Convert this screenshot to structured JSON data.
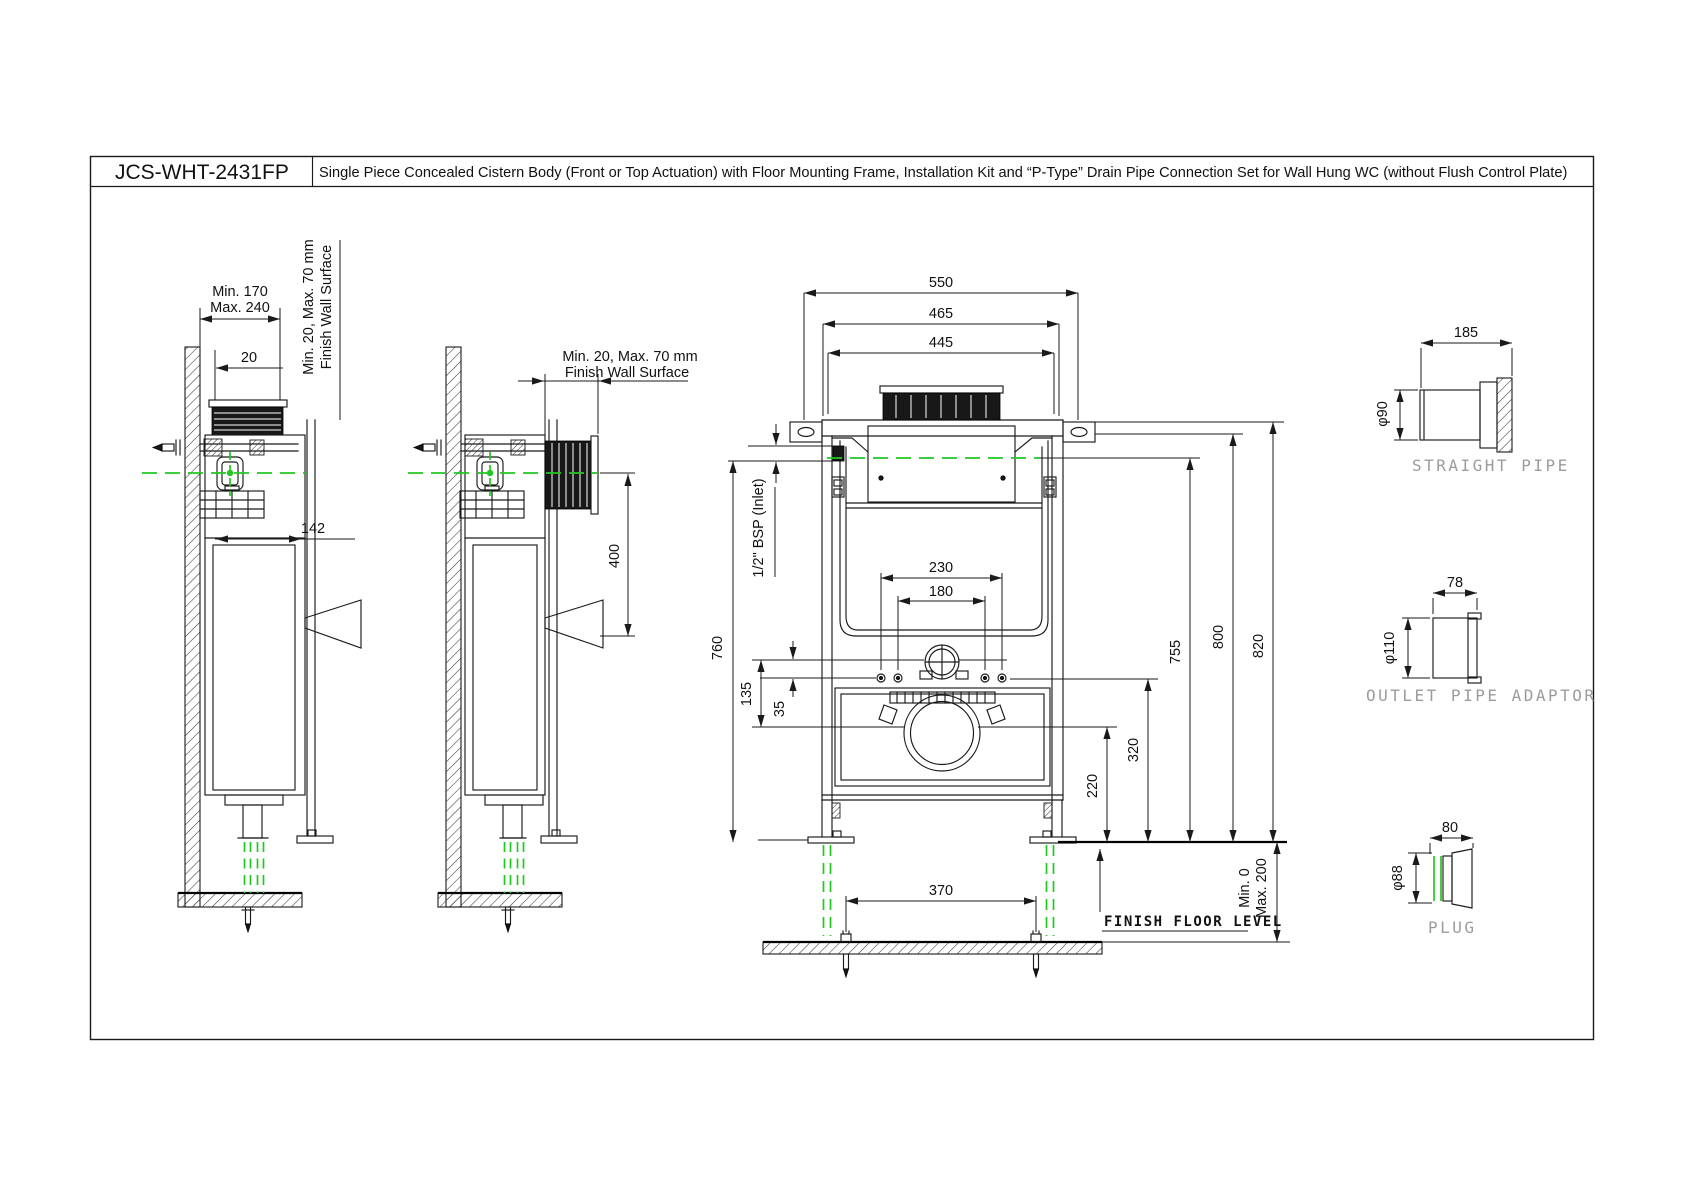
{
  "title": {
    "model": "JCS-WHT-2431FP",
    "description": "Single Piece Concealed Cistern Body (Front or Top Actuation) with Floor Mounting Frame, Installation Kit and “P-Type” Drain Pipe Connection Set for Wall Hung WC (without Flush Control Plate)"
  },
  "colors": {
    "line": "#1a1a1a",
    "centerline": "#22c822",
    "accessory_label": "#9c9c9c",
    "floor_label": "#111111",
    "background": "#ffffff"
  },
  "side_view_top_actuation": {
    "wall_offset_min": "Min. 170",
    "wall_offset_max": "Max. 240",
    "tube_gap": "20",
    "body_depth": "142",
    "finish_wall_line1": "Min. 20, Max. 70 mm",
    "finish_wall_line2": "Finish Wall Surface"
  },
  "side_view_front_actuation": {
    "finish_wall_line1": "Min. 20, Max. 70 mm",
    "finish_wall_line2": "Finish Wall Surface",
    "actuation_span": "400"
  },
  "front_view": {
    "overall_width": "550",
    "frame_width": "465",
    "inner_width": "445",
    "inlet_label": "1/2\" BSP (Inlet)",
    "bolt_spacing_outer": "230",
    "bolt_spacing_inner": "180",
    "inlet_height": "760",
    "inlet_to_outlet": "135",
    "inlet_to_bolt": "35",
    "inlet_height_right": "755",
    "frame_top_height": "800",
    "overall_height": "820",
    "bolt_height": "320",
    "outlet_height": "220",
    "anchor_spacing": "370",
    "floor_min": "Min. 0",
    "floor_max": "Max. 200",
    "floor_label": "FINISH FLOOR LEVEL"
  },
  "accessories": {
    "straight_pipe": {
      "label": "STRAIGHT PIPE",
      "length": "185",
      "diameter": "φ90"
    },
    "outlet_pipe_adaptor": {
      "label": "OUTLET PIPE ADAPTOR",
      "length": "78",
      "diameter": "φ110"
    },
    "plug": {
      "label": "PLUG",
      "length": "80",
      "diameter": "φ88"
    }
  }
}
